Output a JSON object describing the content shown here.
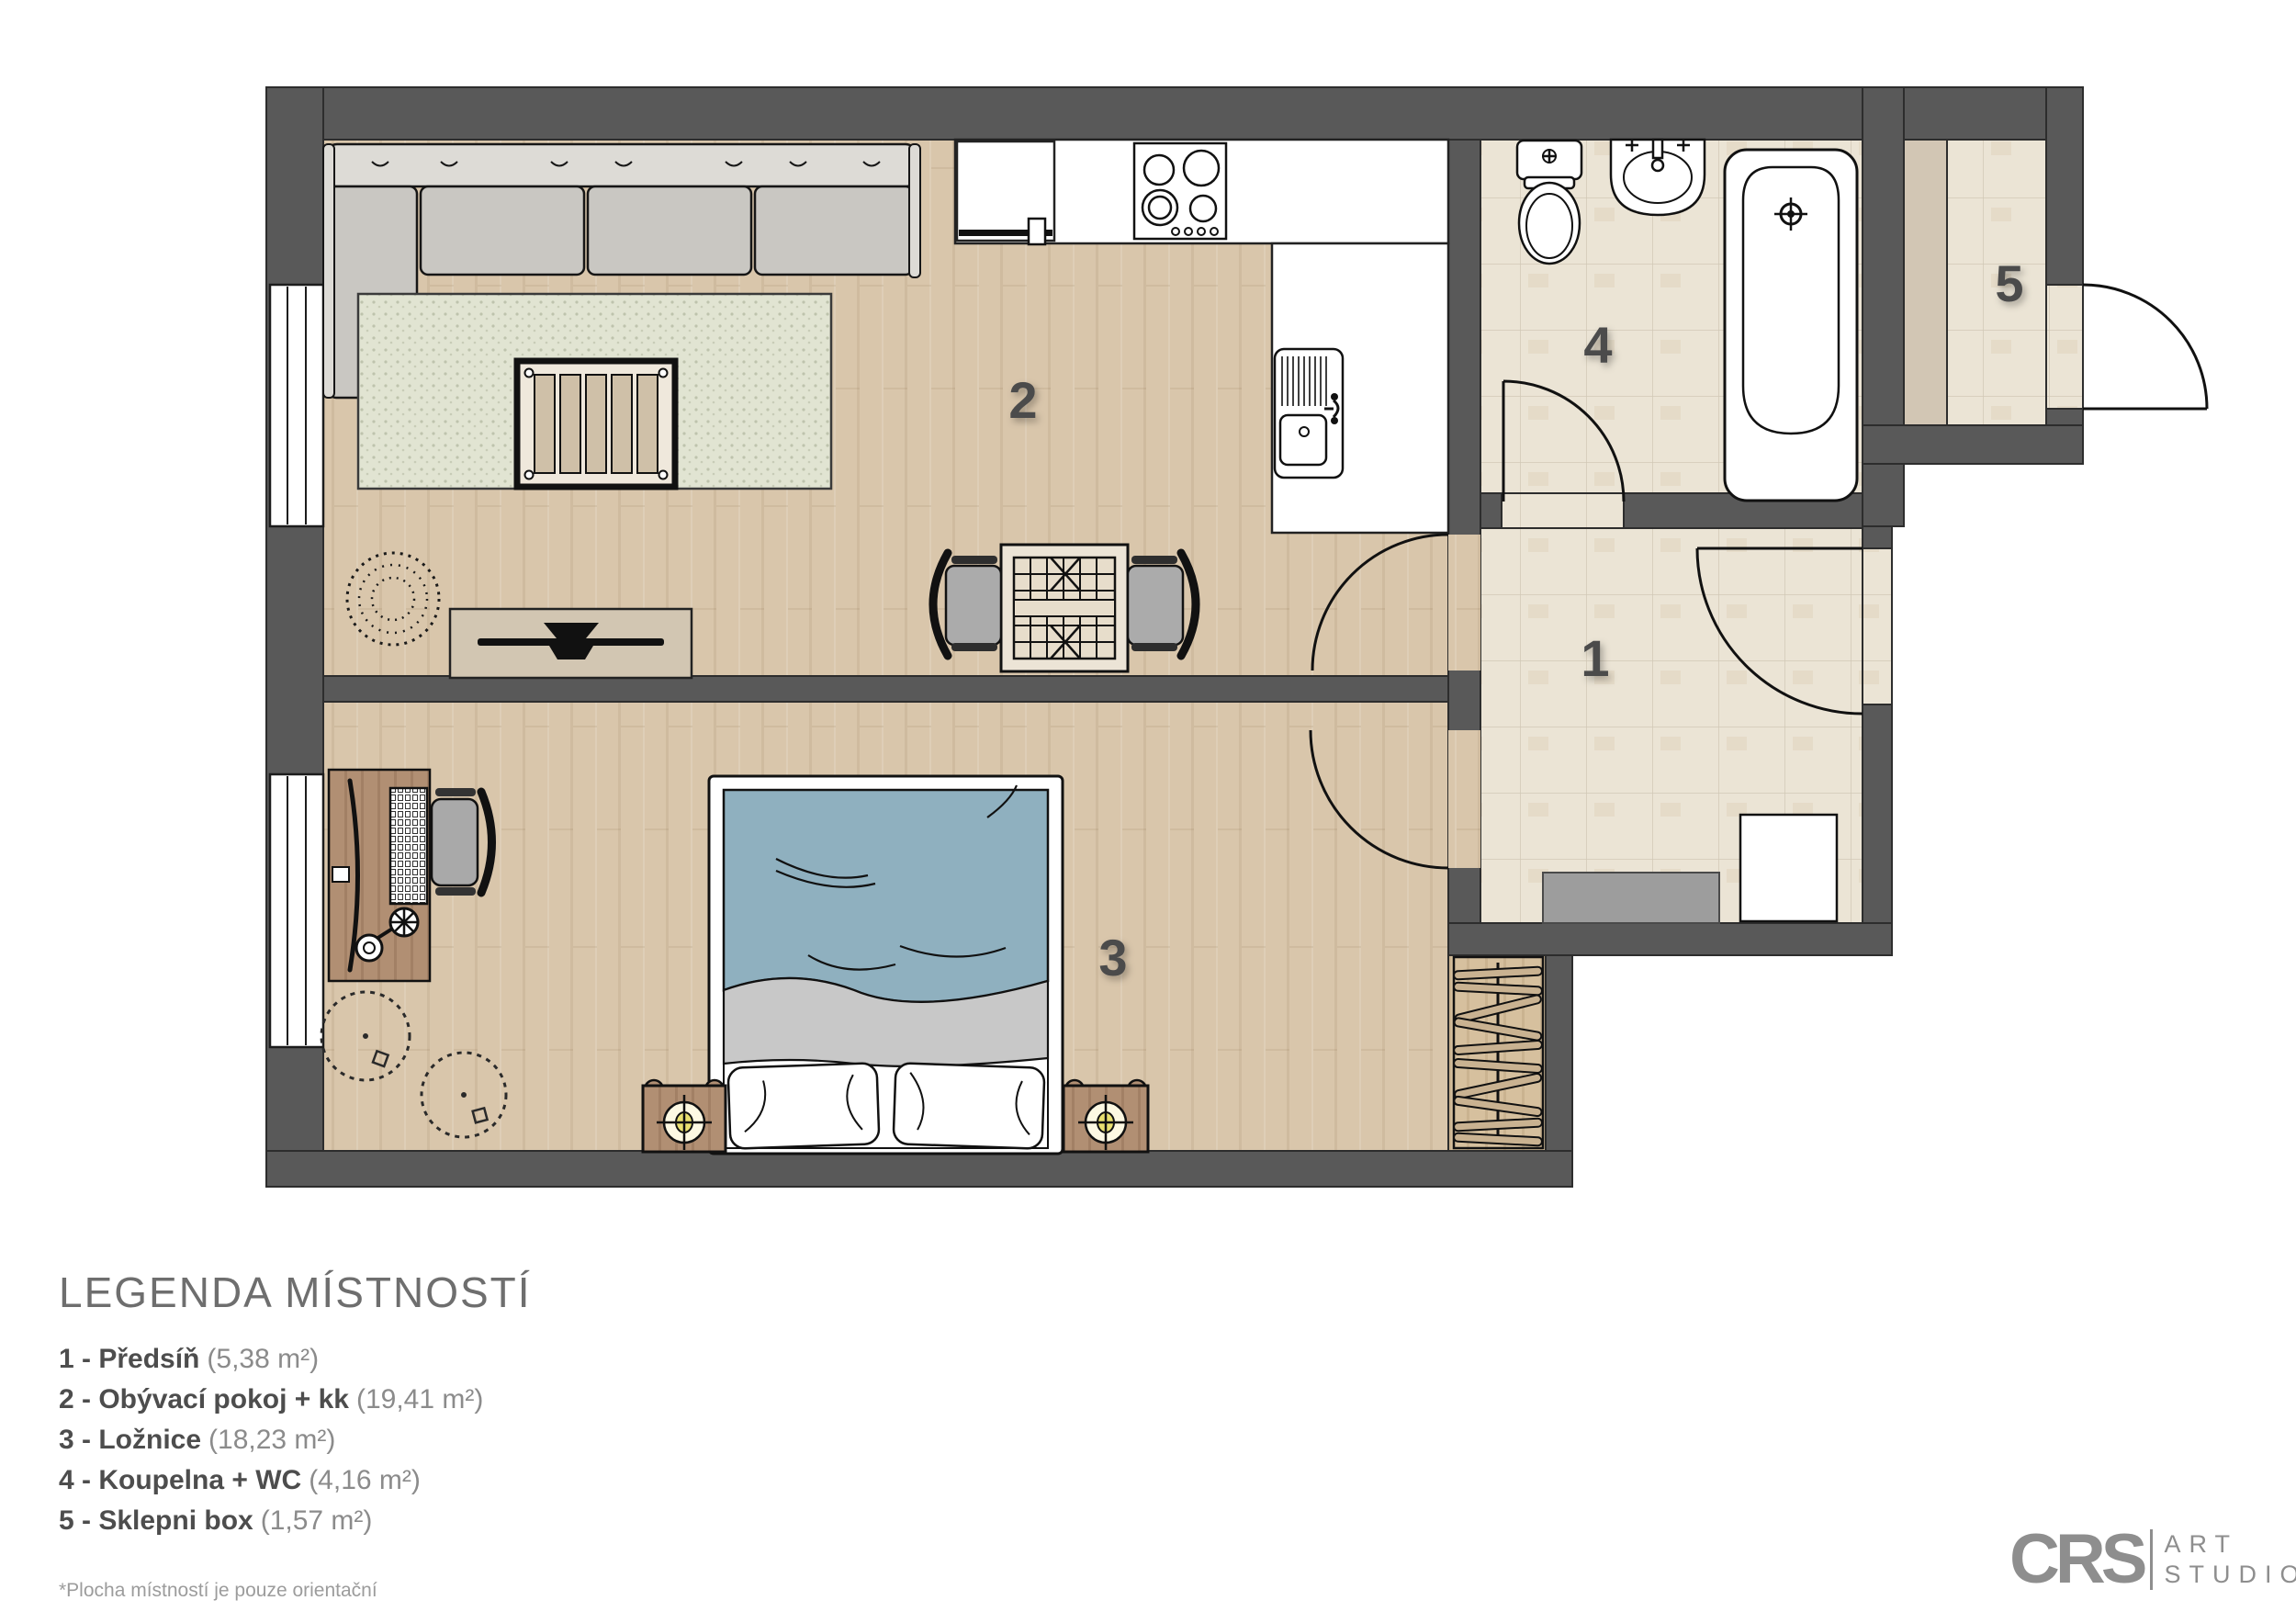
{
  "plan": {
    "type": "apartment-floor-plan",
    "room_numbers": {
      "r1": "1",
      "r2": "2",
      "r3": "3",
      "r4": "4",
      "r5": "5"
    }
  },
  "legend": {
    "title": "LEGENDA MÍSTNOSTÍ",
    "items": [
      {
        "label": "1 - Předsíň",
        "area": "(5,38 m²)"
      },
      {
        "label": "2 - Obývací pokoj + kk",
        "area": "(19,41 m²)"
      },
      {
        "label": "3 - Ložnice",
        "area": "(18,23 m²)"
      },
      {
        "label": "4 - Koupelna + WC",
        "area": "(4,16 m²)"
      },
      {
        "label": "5 - Sklepni box",
        "area": "(1,57 m²)"
      }
    ],
    "footnote": "*Plocha místností je pouze orientační"
  },
  "logo": {
    "abbr": "CRS",
    "word1": "ART",
    "word2": "STUDIO"
  },
  "colors": {
    "wall": "#595959",
    "wood_floor": "#d9c6ab",
    "tile_floor": "#ebe4d5",
    "rug": "#e1e4d2",
    "blanket_blue": "#8fb0bf",
    "furniture_wood": "#b18f73",
    "tan": "#d2c6b4",
    "room_number": "#4b4b4b"
  }
}
